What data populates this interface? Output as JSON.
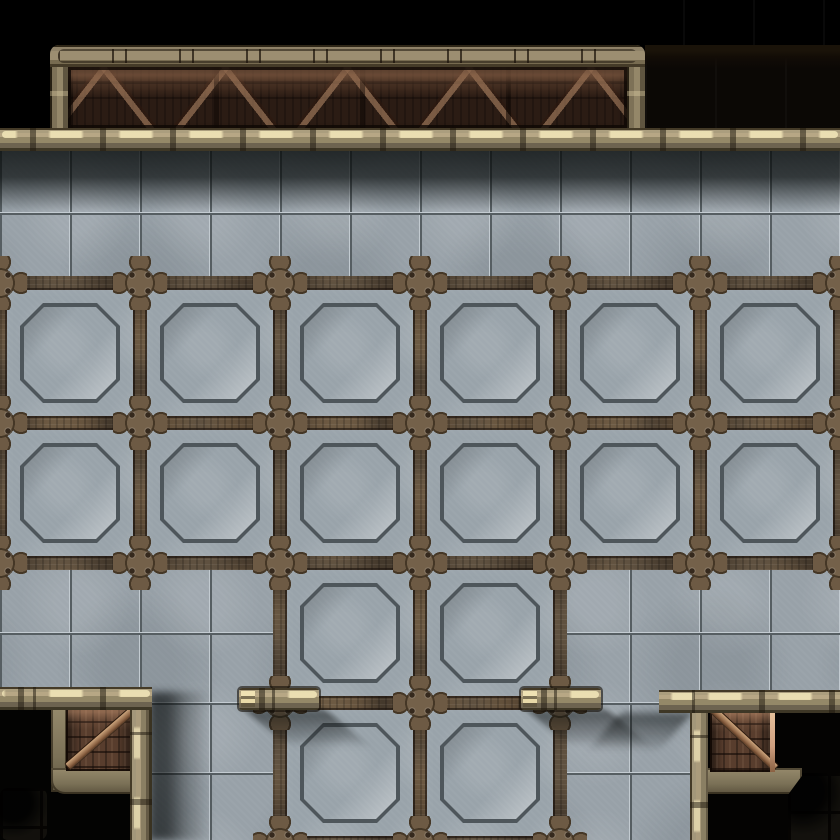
{
  "app": {
    "type": "virtual-tabletop-map-screenshot",
    "view": "top-down",
    "theme": "industrial-scifi-dungeon-tiles"
  },
  "palette": {
    "bg": "#000000",
    "floor": "#98a1a8",
    "tileLineDark": "#565e62",
    "tileLineLight": "#c3cbd1",
    "frame": "#5f5140",
    "panelFace": "#99a3aa",
    "octGroove": "#4e565b",
    "ledgeHighlight": "#f0e4ba",
    "bridgeIn": "#2b1c14",
    "rust": "#583d2d",
    "doorHighlight": "#cf9f7f",
    "outsideDark": "#0b0805"
  },
  "scene": {
    "structures": {
      "bridge": {
        "label": "north catwalk bridge",
        "position": "top",
        "braced_window": true
      },
      "north_wall": {
        "label": "full-width wall ledge"
      },
      "floor": {
        "label": "concrete tile floor",
        "tile_size_px": 70
      },
      "panel_grid": {
        "label": "riveted metal-framed floor panels",
        "cell_size_px": 140,
        "full_rows": 2,
        "full_cols": 6,
        "center_rows": 2,
        "center_cols": 2
      },
      "doorways": [
        {
          "side": "southwest",
          "door": "rusted metal door"
        },
        {
          "side": "southeast",
          "door": "rusted metal door"
        }
      ],
      "wall_stubs": [
        {
          "side": "south-center-left"
        },
        {
          "side": "south-center-right"
        }
      ]
    }
  }
}
